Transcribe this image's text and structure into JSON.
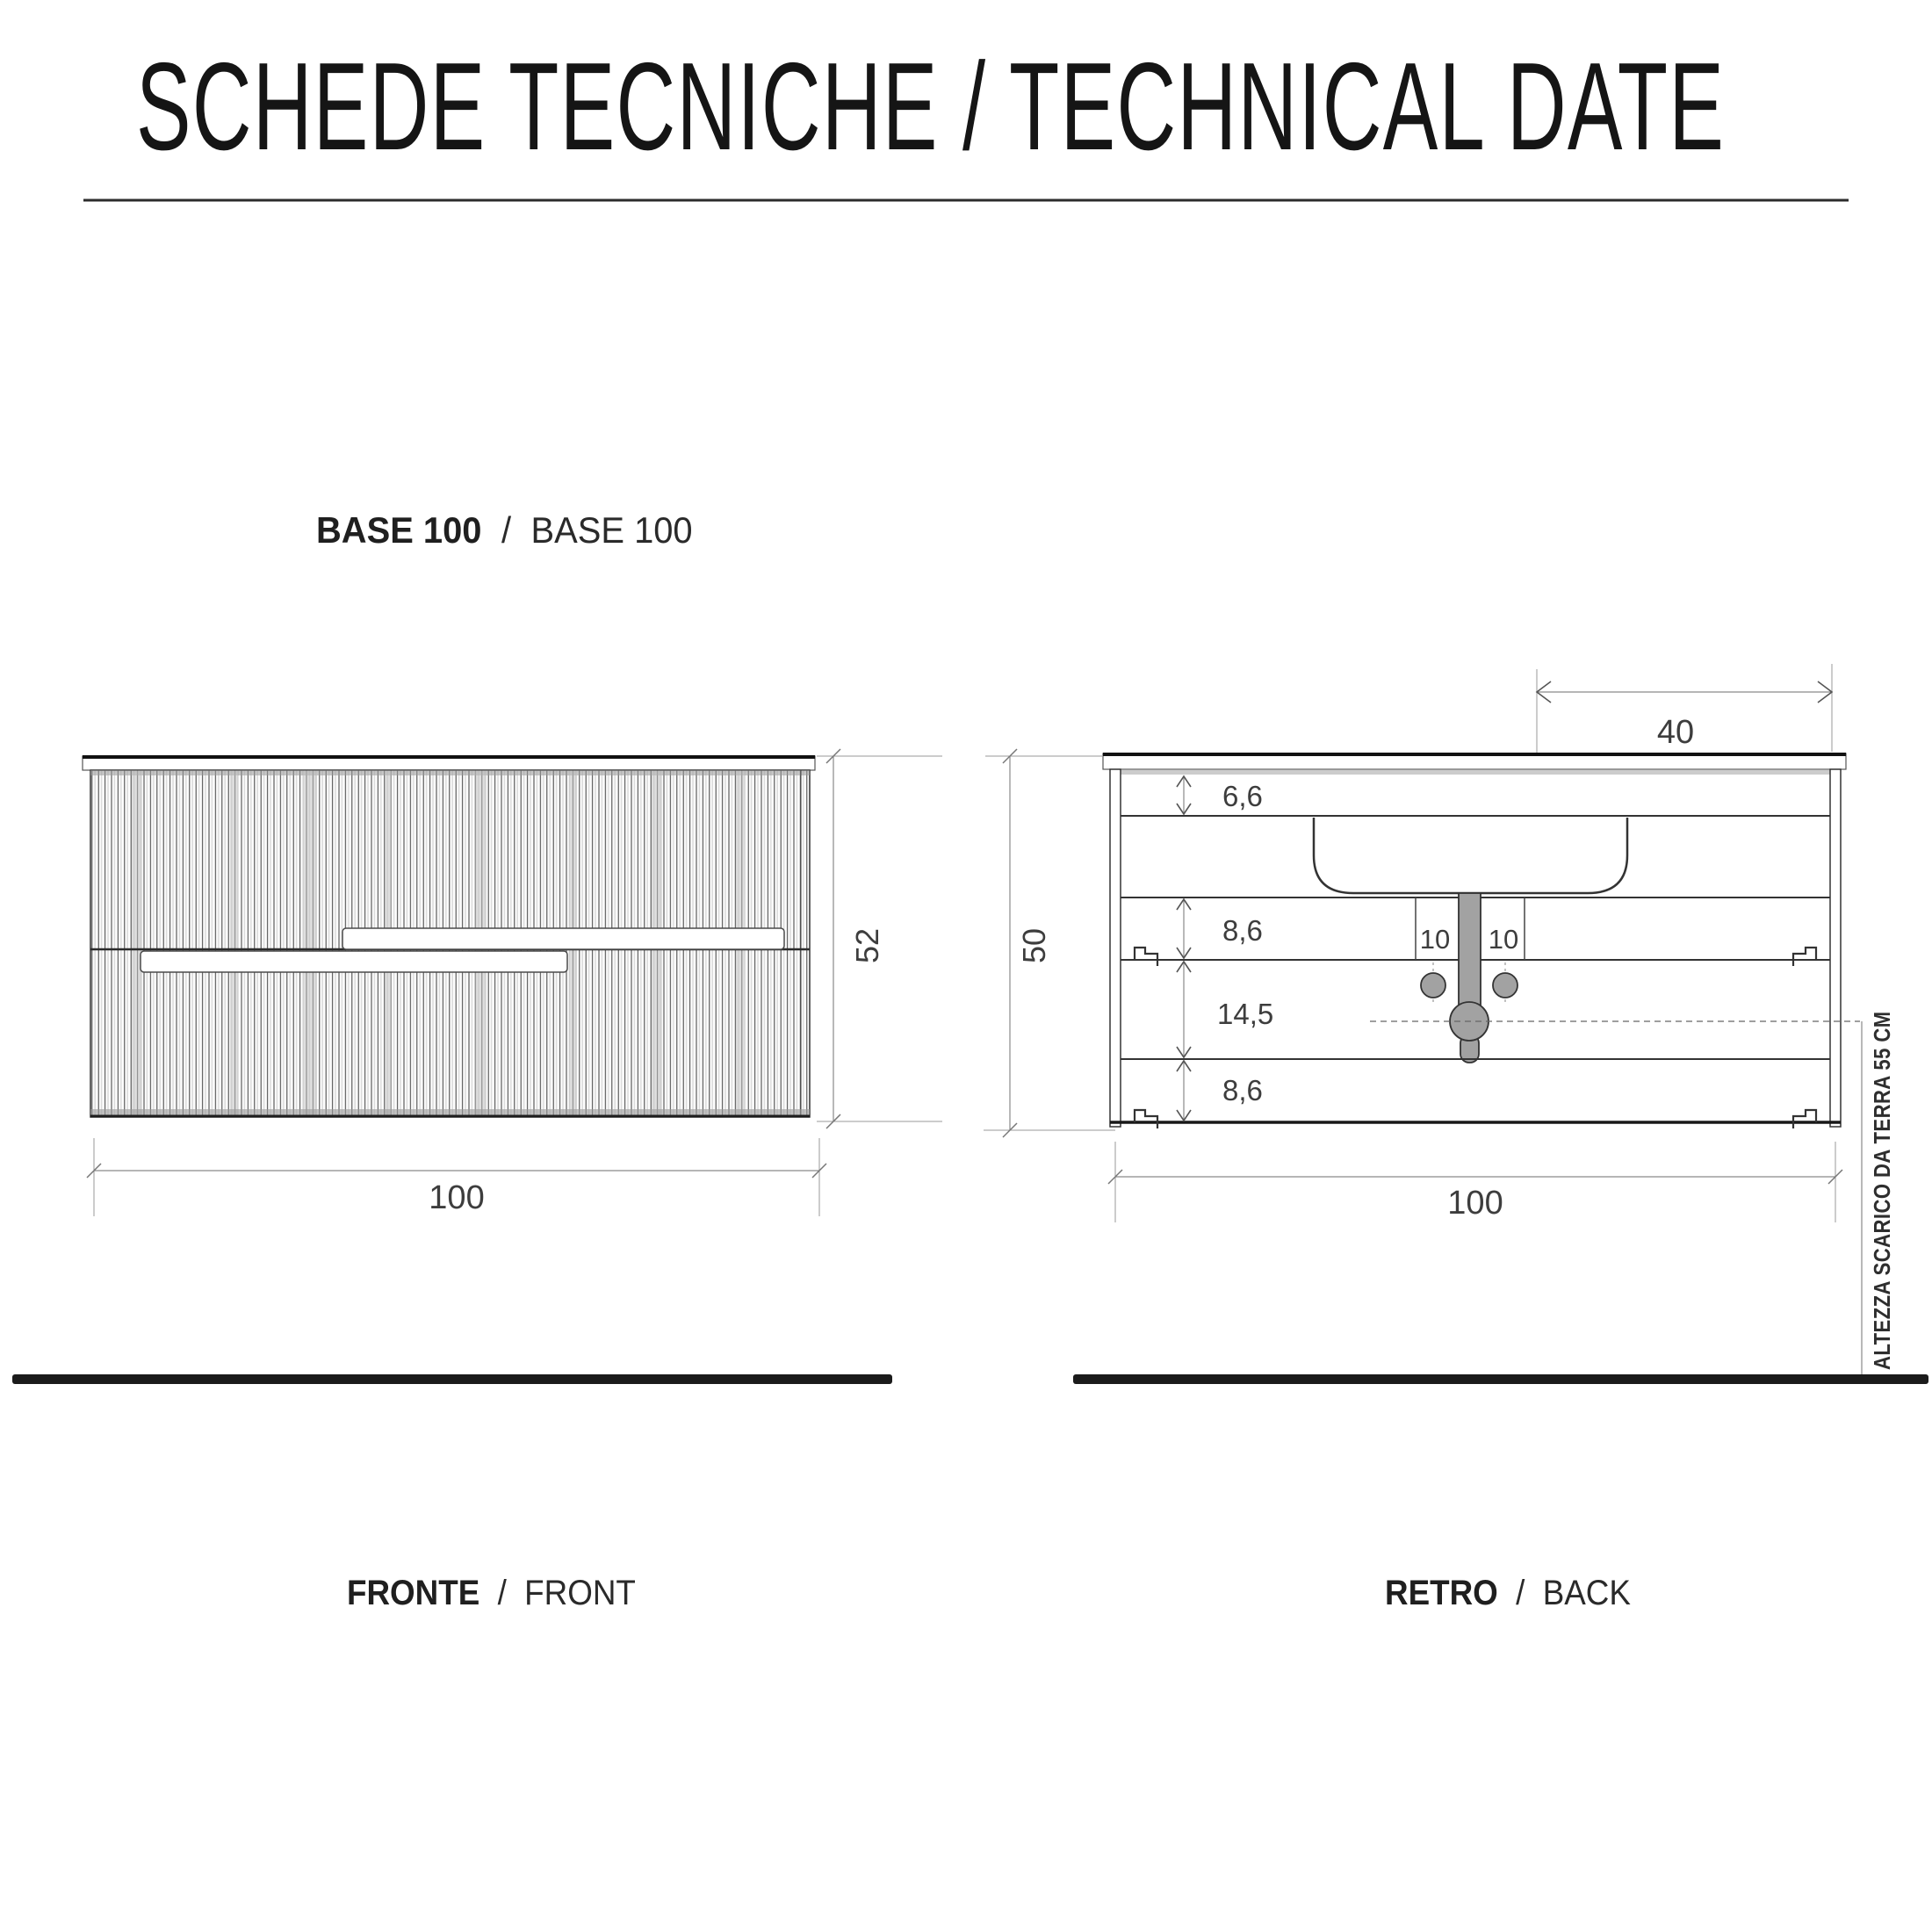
{
  "page": {
    "title": "SCHEDE TECNICHE / TECHNICAL DATE"
  },
  "product": {
    "label_bold": "BASE 100",
    "separator": "/",
    "label_regular": "BASE 100"
  },
  "front_view": {
    "caption_bold": "FRONTE",
    "caption_sep": "/",
    "caption_regular": "FRONT",
    "width_cm": "100",
    "height_cm": "52"
  },
  "back_view": {
    "caption_bold": "RETRO",
    "caption_sep": "/",
    "caption_regular": "BACK",
    "width_cm": "100",
    "height_cm": "50",
    "top_dim_cm": "40",
    "rail_top_cm": "6,6",
    "rail_mid_cm": "8,6",
    "gap_cm": "14,5",
    "rail_bottom_cm": "8,6",
    "hole_left_cm": "10",
    "hole_right_cm": "10",
    "drain_note": "ALTEZZA SCARICO DA TERRA 55 CM"
  },
  "colors": {
    "ink": "#151515",
    "outline": "#333333",
    "dim": "#8a8a8a",
    "plumbing_gray": "#a2a2a2",
    "floor": "#1b1b1b"
  }
}
